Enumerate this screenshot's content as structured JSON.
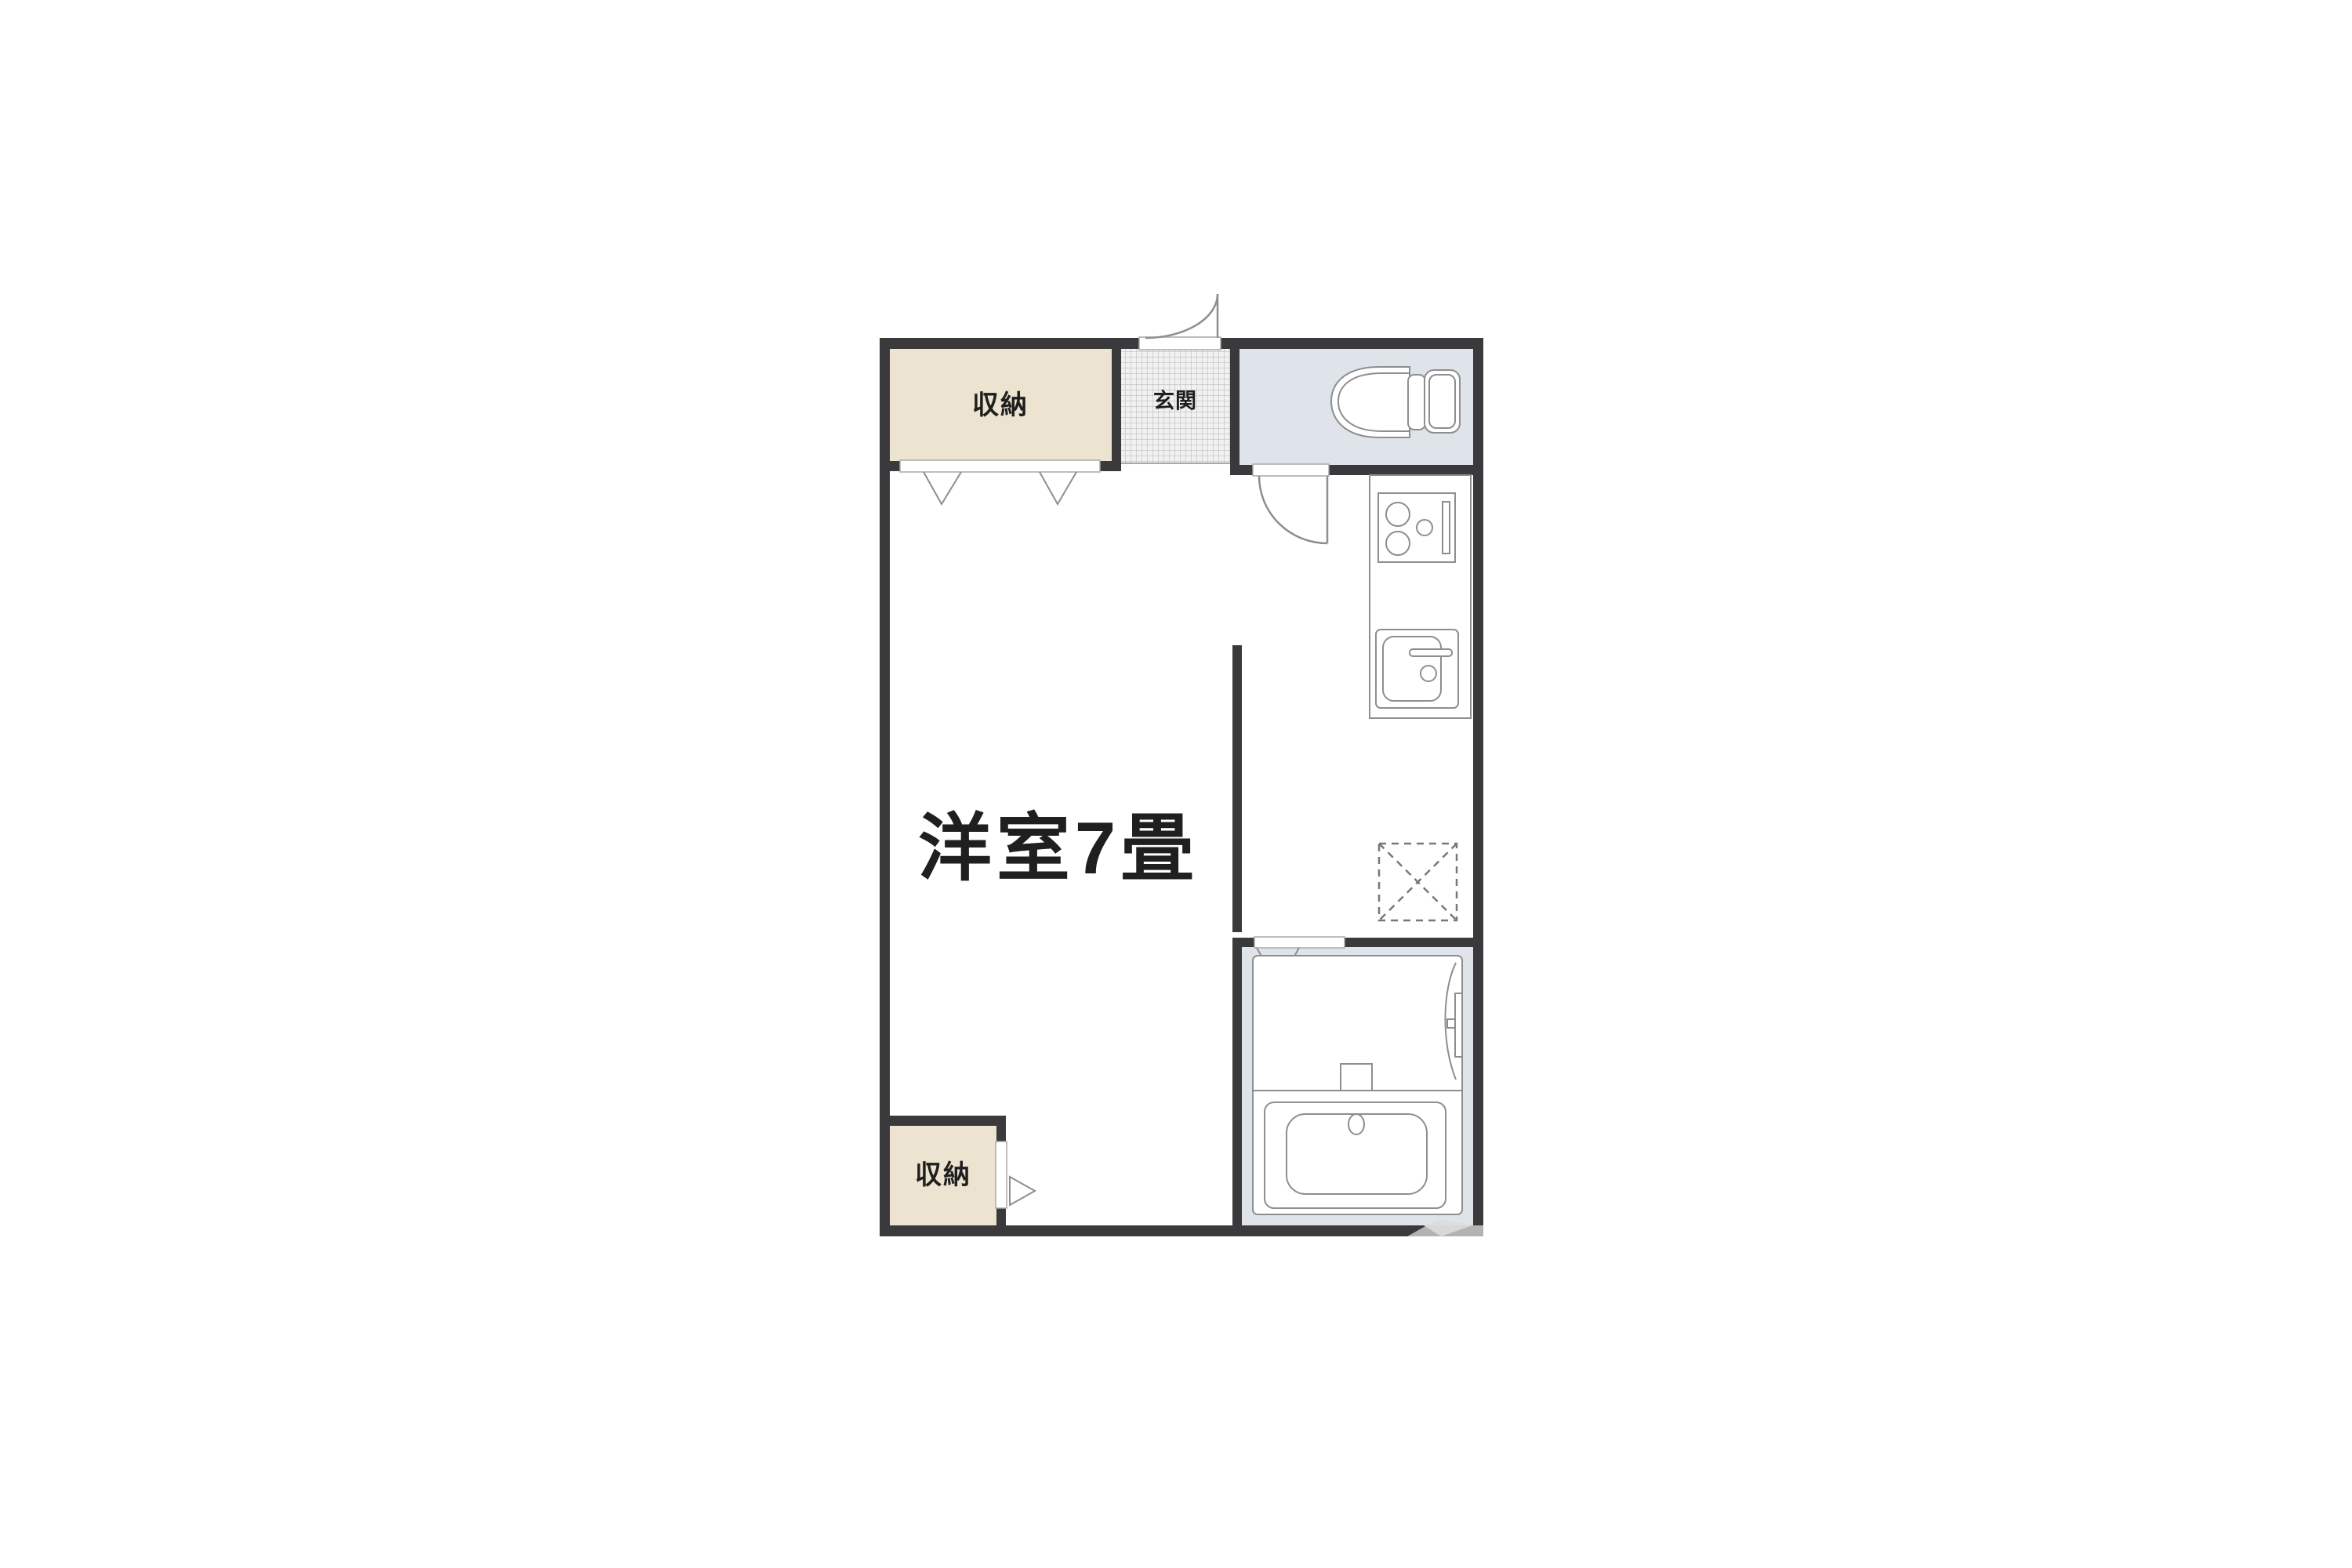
{
  "floor_plan": {
    "labels": {
      "storage_top": "収納",
      "entrance": "玄関",
      "main_room": "洋室7畳",
      "storage_bottom": "収納"
    },
    "rooms": [
      {
        "name": "storage-top",
        "label": "収納",
        "type": "closet"
      },
      {
        "name": "entrance",
        "label": "玄関",
        "type": "genkan-tiled"
      },
      {
        "name": "toilet-room",
        "label": "",
        "type": "wet-area"
      },
      {
        "name": "kitchen-strip",
        "label": "",
        "type": "kitchen"
      },
      {
        "name": "main-room",
        "label": "洋室7畳",
        "type": "western-room-7-tatami"
      },
      {
        "name": "storage-bottom",
        "label": "収納",
        "type": "closet"
      },
      {
        "name": "bathroom",
        "label": "",
        "type": "unit-bath"
      }
    ],
    "fixtures": [
      "toilet-icon",
      "stove-icon",
      "kitchen-sink-icon",
      "kitchen-counter",
      "washing-machine-space-icon",
      "bathtub-icon",
      "bath-vanity-icon",
      "entrance-door-swing",
      "toilet-door-swing",
      "closet-bifold-chevrons",
      "bathroom-door-chevron",
      "closet-door-triangle"
    ],
    "colors": {
      "page_bg": "#ffffff",
      "wall": "#3a3a3c",
      "room_white": "#ffffff",
      "storage_fill": "#ece4d0",
      "wet_area_fill": "#dee4e9",
      "hatch_bg": "#f1f1f1",
      "hatch_line": "#b4b4b4",
      "fixture_stroke": "#8e8e8e",
      "opening_stroke": "#a8a8a8",
      "dashed_stroke": "#787878",
      "text": "#1f1f1f"
    }
  }
}
